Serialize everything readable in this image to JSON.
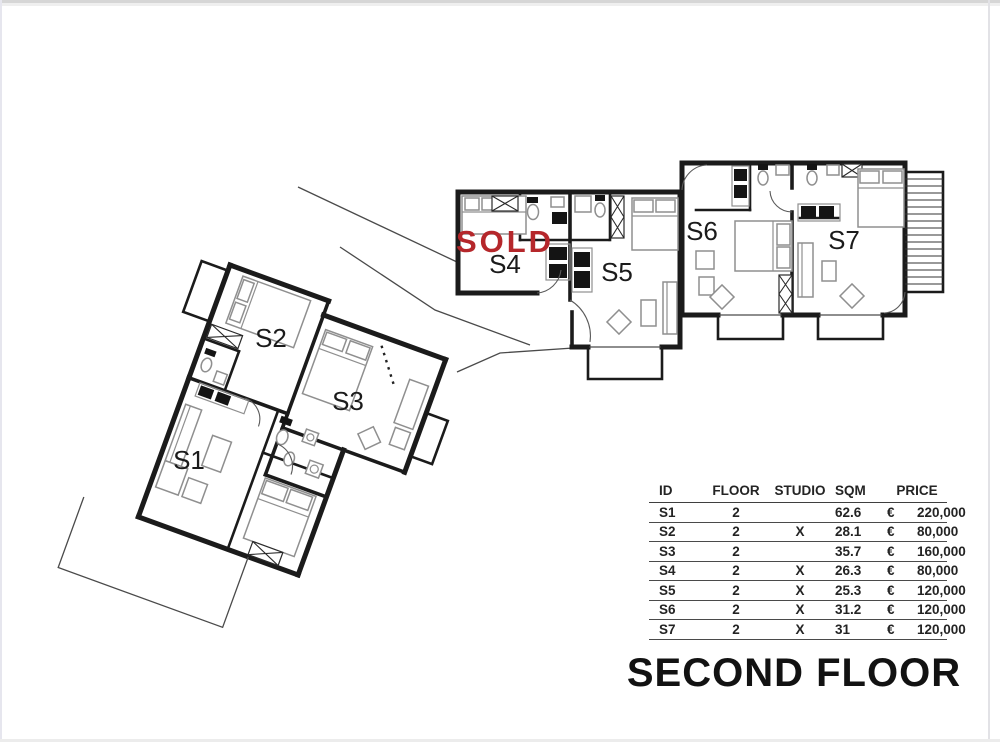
{
  "plan": {
    "sold_label": "SOLD",
    "sold_color": "#b5272b",
    "units": [
      {
        "id": "S1",
        "label": "S1"
      },
      {
        "id": "S2",
        "label": "S2"
      },
      {
        "id": "S3",
        "label": "S3"
      },
      {
        "id": "S4",
        "label": "S4"
      },
      {
        "id": "S5",
        "label": "S5"
      },
      {
        "id": "S6",
        "label": "S6"
      },
      {
        "id": "S7",
        "label": "S7"
      }
    ]
  },
  "table": {
    "headers": {
      "id": "ID",
      "floor": "FLOOR",
      "studio": "STUDIO",
      "sqm": "SQM",
      "price": "PRICE"
    },
    "currency_symbol": "€",
    "rows": [
      {
        "id": "S1",
        "floor": "2",
        "studio": "",
        "sqm": "62.6",
        "price": "220,000"
      },
      {
        "id": "S2",
        "floor": "2",
        "studio": "X",
        "sqm": "28.1",
        "price": "80,000"
      },
      {
        "id": "S3",
        "floor": "2",
        "studio": "",
        "sqm": "35.7",
        "price": "160,000"
      },
      {
        "id": "S4",
        "floor": "2",
        "studio": "X",
        "sqm": "26.3",
        "price": "80,000"
      },
      {
        "id": "S5",
        "floor": "2",
        "studio": "X",
        "sqm": "25.3",
        "price": "120,000"
      },
      {
        "id": "S6",
        "floor": "2",
        "studio": "X",
        "sqm": "31.2",
        "price": "120,000"
      },
      {
        "id": "S7",
        "floor": "2",
        "studio": "X",
        "sqm": "31",
        "price": "120,000"
      }
    ]
  },
  "title": {
    "text": "SECOND FLOOR"
  }
}
